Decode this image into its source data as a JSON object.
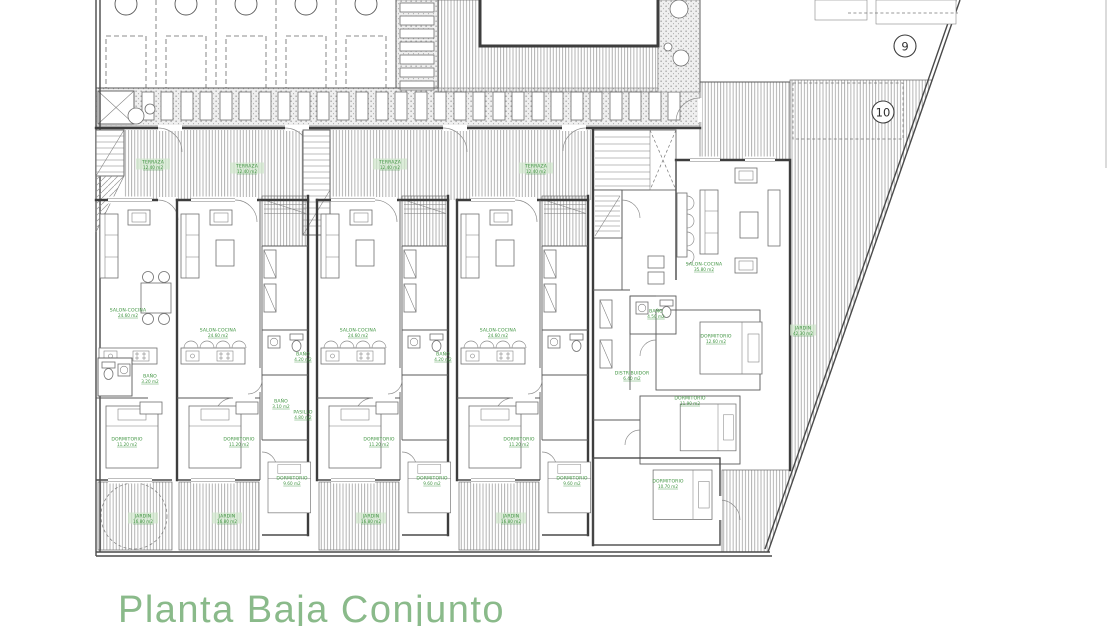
{
  "title": {
    "text": "Planta Baja Conjunto"
  },
  "markers": {
    "plot9": "9",
    "plot10": "10"
  },
  "colors": {
    "label_green": "#3f9440",
    "title_green": "#8aba8a",
    "line": "#3d3d3d",
    "hatch": "#9a9a9a"
  },
  "rooms": [
    {
      "name": "TERRAZA",
      "area": "12.40 m2"
    },
    {
      "name": "TERRAZA",
      "area": "12.40 m2"
    },
    {
      "name": "TERRAZA",
      "area": "12.40 m2"
    },
    {
      "name": "TERRAZA",
      "area": "12.40 m2"
    },
    {
      "name": "SALON-COCINA",
      "area": "24.60 m2"
    },
    {
      "name": "SALON-COCINA",
      "area": "24.60 m2"
    },
    {
      "name": "SALON-COCINA",
      "area": "24.60 m2"
    },
    {
      "name": "SALON-COCINA",
      "area": "24.60 m2"
    },
    {
      "name": "SALON-COCINA",
      "area": "35.80 m2"
    },
    {
      "name": "BAÑO",
      "area": "4.20 m2"
    },
    {
      "name": "BAÑO",
      "area": "4.20 m2"
    },
    {
      "name": "BAÑO",
      "area": "3.10 m2"
    },
    {
      "name": "PASILLO",
      "area": "4.80 m2"
    },
    {
      "name": "DORMITORIO",
      "area": "11.20 m2"
    },
    {
      "name": "DORMITORIO",
      "area": "11.20 m2"
    },
    {
      "name": "DORMITORIO",
      "area": "11.20 m2"
    },
    {
      "name": "DORMITORIO",
      "area": "11.20 m2"
    },
    {
      "name": "DORMITORIO",
      "area": "9.60 m2"
    },
    {
      "name": "JARDIN",
      "area": "16.80 m2"
    },
    {
      "name": "JARDIN",
      "area": "16.80 m2"
    },
    {
      "name": "JARDIN",
      "area": "16.80 m2"
    },
    {
      "name": "JARDIN",
      "area": "16.80 m2"
    },
    {
      "name": "BAÑO",
      "area": "4.50 m2"
    },
    {
      "name": "DORMITORIO",
      "area": "12.60 m2"
    },
    {
      "name": "DISTRIBUIDOR",
      "area": "6.40 m2"
    },
    {
      "name": "DORMITORIO",
      "area": "11.90 m2"
    },
    {
      "name": "DORMITORIO",
      "area": "10.70 m2"
    },
    {
      "name": "JARDIN",
      "area": "42.30 m2"
    },
    {
      "name": "BAÑO",
      "area": "3.20 m2"
    },
    {
      "name": "DORMITORIO",
      "area": "9.60 m2"
    },
    {
      "name": "DORMITORIO",
      "area": "9.60 m2"
    }
  ]
}
